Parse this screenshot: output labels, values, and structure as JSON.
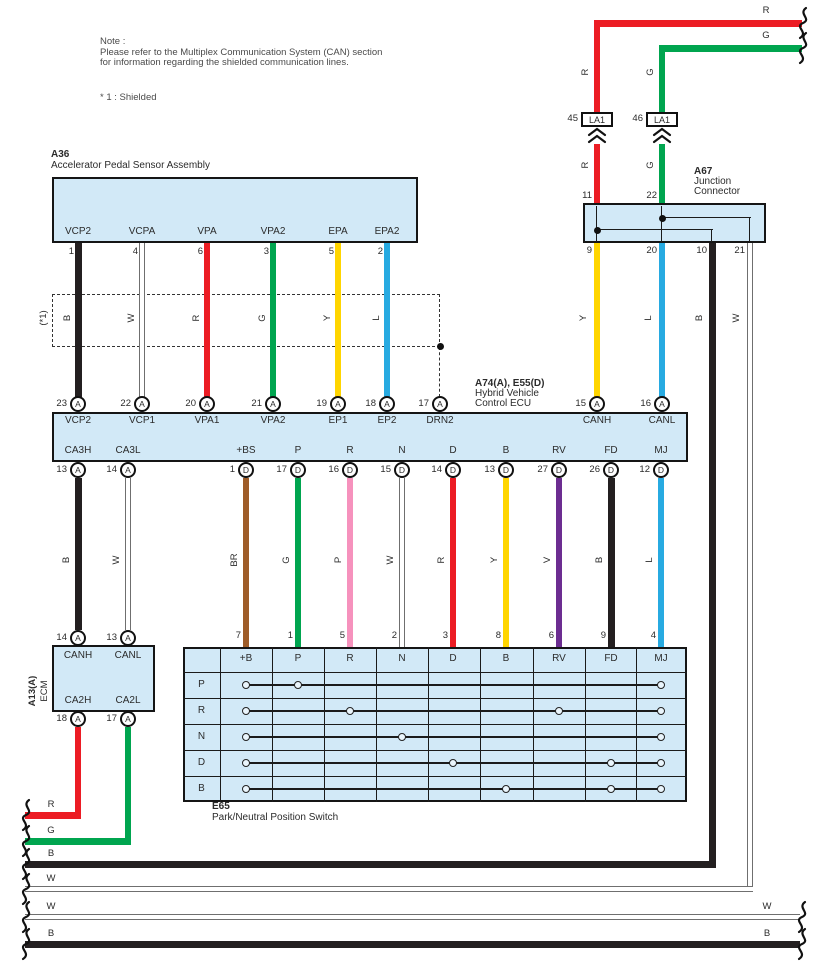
{
  "note": {
    "title": "Note :",
    "line1": "Please refer to the Multiplex Communication System (CAN) section",
    "line2": "for information regarding the shielded communication lines.",
    "shield_note": "* 1 : Shielded",
    "shield_tag": "(*1)"
  },
  "colors": {
    "R": "#ec1c24",
    "G": "#00a54f",
    "Y": "#ffd500",
    "L": "#27aae1",
    "B": "#231f20",
    "W": "#ffffff",
    "P": "#f692bd",
    "BR": "#9e5c28",
    "V": "#6c2d91",
    "box_fill": "#d2e9f7",
    "box_border": "#151515"
  },
  "components": {
    "a36": {
      "code": "A36",
      "name": "Accelerator Pedal Sensor Assembly",
      "terminals": [
        {
          "name": "VCP2",
          "pin": "1",
          "wire": "B"
        },
        {
          "name": "VCPA",
          "pin": "4",
          "wire": "W"
        },
        {
          "name": "VPA",
          "pin": "6",
          "wire": "R"
        },
        {
          "name": "VPA2",
          "pin": "3",
          "wire": "G"
        },
        {
          "name": "EPA",
          "pin": "5",
          "wire": "Y"
        },
        {
          "name": "EPA2",
          "pin": "2",
          "wire": "L"
        }
      ]
    },
    "ecu": {
      "code": "A74(A), E55(D)",
      "name_line1": "Hybrid Vehicle",
      "name_line2": "Control ECU",
      "top_terminals": [
        {
          "name": "VCP2",
          "pin": "23",
          "conn": "A"
        },
        {
          "name": "VCP1",
          "pin": "22",
          "conn": "A"
        },
        {
          "name": "VPA1",
          "pin": "20",
          "conn": "A"
        },
        {
          "name": "VPA2",
          "pin": "21",
          "conn": "A"
        },
        {
          "name": "EP1",
          "pin": "19",
          "conn": "A"
        },
        {
          "name": "EP2",
          "pin": "18",
          "conn": "A"
        },
        {
          "name": "DRN2",
          "pin": "17",
          "conn": "A"
        },
        {
          "name": "CANH",
          "pin": "15",
          "conn": "A"
        },
        {
          "name": "CANL",
          "pin": "16",
          "conn": "A"
        }
      ],
      "bottom_terminals": [
        {
          "name": "CA3H",
          "pin": "13",
          "conn": "A",
          "wire": "B"
        },
        {
          "name": "CA3L",
          "pin": "14",
          "conn": "A",
          "wire": "W"
        },
        {
          "name": "+BS",
          "pin": "1",
          "conn": "D",
          "wire": "BR"
        },
        {
          "name": "P",
          "pin": "17",
          "conn": "D",
          "wire": "G"
        },
        {
          "name": "R",
          "pin": "16",
          "conn": "D",
          "wire": "P"
        },
        {
          "name": "N",
          "pin": "15",
          "conn": "D",
          "wire": "W"
        },
        {
          "name": "D",
          "pin": "14",
          "conn": "D",
          "wire": "R"
        },
        {
          "name": "B",
          "pin": "13",
          "conn": "D",
          "wire": "Y"
        },
        {
          "name": "RV",
          "pin": "27",
          "conn": "D",
          "wire": "V"
        },
        {
          "name": "FD",
          "pin": "26",
          "conn": "D",
          "wire": "B"
        },
        {
          "name": "MJ",
          "pin": "12",
          "conn": "D",
          "wire": "L"
        }
      ]
    },
    "a67": {
      "code": "A67",
      "name_line1": "Junction",
      "name_line2": "Connector",
      "top_pins": [
        {
          "pin": "11",
          "wire": "R"
        },
        {
          "pin": "22",
          "wire": "G"
        }
      ],
      "bottom_pins": [
        {
          "pin": "9",
          "wire": "Y"
        },
        {
          "pin": "20",
          "wire": "L"
        },
        {
          "pin": "10",
          "wire": "B"
        },
        {
          "pin": "21",
          "wire": "W"
        }
      ]
    },
    "ecm": {
      "code": "A13(A)",
      "name": "ECM",
      "top_terminals": [
        {
          "name": "CANH",
          "pin": "14",
          "conn": "A"
        },
        {
          "name": "CANL",
          "pin": "13",
          "conn": "A"
        }
      ],
      "bottom_terminals": [
        {
          "name": "CA2H",
          "pin": "18",
          "conn": "A",
          "wire": "R"
        },
        {
          "name": "CA2L",
          "pin": "17",
          "conn": "A",
          "wire": "G"
        }
      ]
    },
    "e65": {
      "code": "E65",
      "name": "Park/Neutral Position Switch",
      "columns": [
        "+B",
        "P",
        "R",
        "N",
        "D",
        "B",
        "RV",
        "FD",
        "MJ"
      ],
      "pin_numbers": [
        "7",
        "1",
        "5",
        "2",
        "3",
        "8",
        "6",
        "9",
        "4"
      ],
      "rows": [
        {
          "label": "P",
          "contacts": [
            "+B",
            "P",
            "MJ"
          ]
        },
        {
          "label": "R",
          "contacts": [
            "+B",
            "R",
            "RV",
            "MJ"
          ]
        },
        {
          "label": "N",
          "contacts": [
            "+B",
            "N",
            "MJ"
          ]
        },
        {
          "label": "D",
          "contacts": [
            "+B",
            "D",
            "FD",
            "MJ"
          ]
        },
        {
          "label": "B",
          "contacts": [
            "+B",
            "B",
            "FD",
            "MJ"
          ]
        }
      ]
    },
    "la1": [
      {
        "pin": "45",
        "label": "LA1"
      },
      {
        "pin": "46",
        "label": "LA1"
      }
    ]
  },
  "edge_wires": {
    "top": [
      {
        "label": "R"
      },
      {
        "label": "G"
      }
    ],
    "bottom": [
      {
        "label": "R"
      },
      {
        "label": "G"
      },
      {
        "label": "B"
      },
      {
        "label": "W"
      },
      {
        "label": "W"
      },
      {
        "label": "B"
      }
    ],
    "bottom_right": [
      {
        "label": "W"
      },
      {
        "label": "B"
      }
    ]
  }
}
